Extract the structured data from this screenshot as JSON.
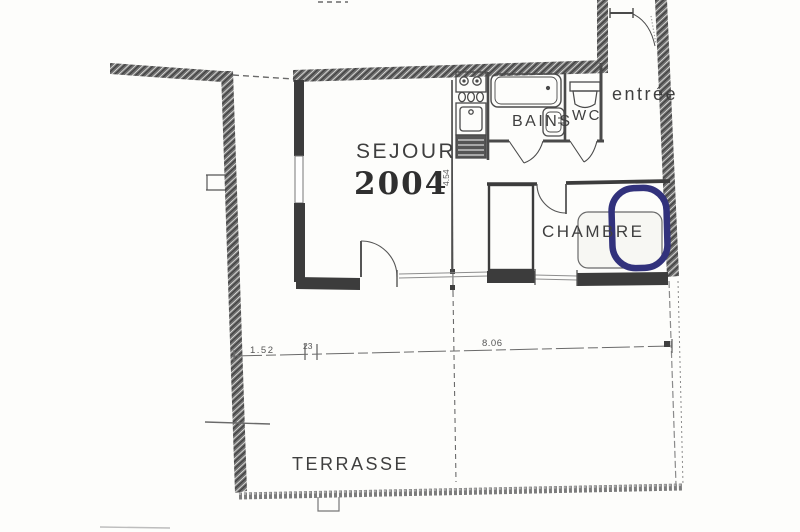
{
  "document": {
    "kind": "scanned-apartment-floor-plan"
  },
  "rooms": {
    "sejour_label": "SEJOUR",
    "sejour_year": "2004",
    "bains_label": "BAINS",
    "wc_label": "WC",
    "entree_label": "entrée",
    "chambre_label": "CHAMBRE",
    "terrasse_label": "TERRASSE"
  },
  "dimensions": {
    "terrasse_left": "1.52",
    "terrasse_small": "23",
    "terrasse_main": "8.06",
    "sejour_vertical": "4.54"
  },
  "highlight": {
    "shape": "hand-drawn-oval-around-bed",
    "color": "#32327c"
  },
  "fixtures": [
    "bathtub",
    "washbasin",
    "toilet",
    "kitchen-hob",
    "kitchen-sink",
    "kitchen-appliance",
    "bed",
    "closet"
  ],
  "colors": {
    "paper": "#fdfdfb",
    "ink": "#3f3f3f",
    "wall_gray": "#6b6b6b",
    "highlight": "#32327c"
  }
}
